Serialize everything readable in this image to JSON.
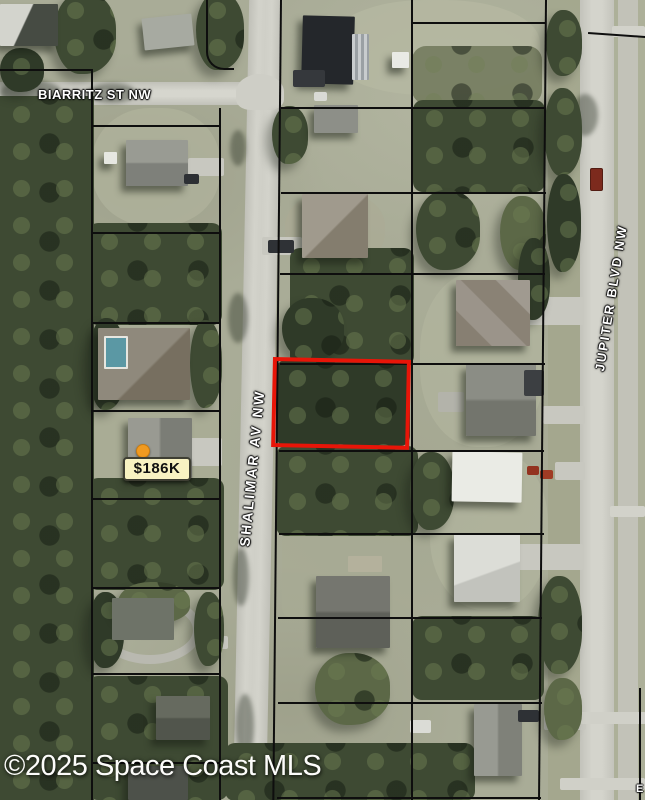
{
  "photo": {
    "watermark": "©2025 Space Coast MLS",
    "edge_label_fragment": "E"
  },
  "streets": {
    "biarritz": "BIARRITZ ST NW",
    "shalimar": "SHALIMAR AV NW",
    "jupiter": "JUPITER BLVD NW"
  },
  "price_marker": {
    "label": "$186K",
    "dot_color": "#f09a20",
    "background": "#f8f2c2",
    "border": "#3e3e33"
  },
  "highlight": {
    "color": "#e81508"
  }
}
